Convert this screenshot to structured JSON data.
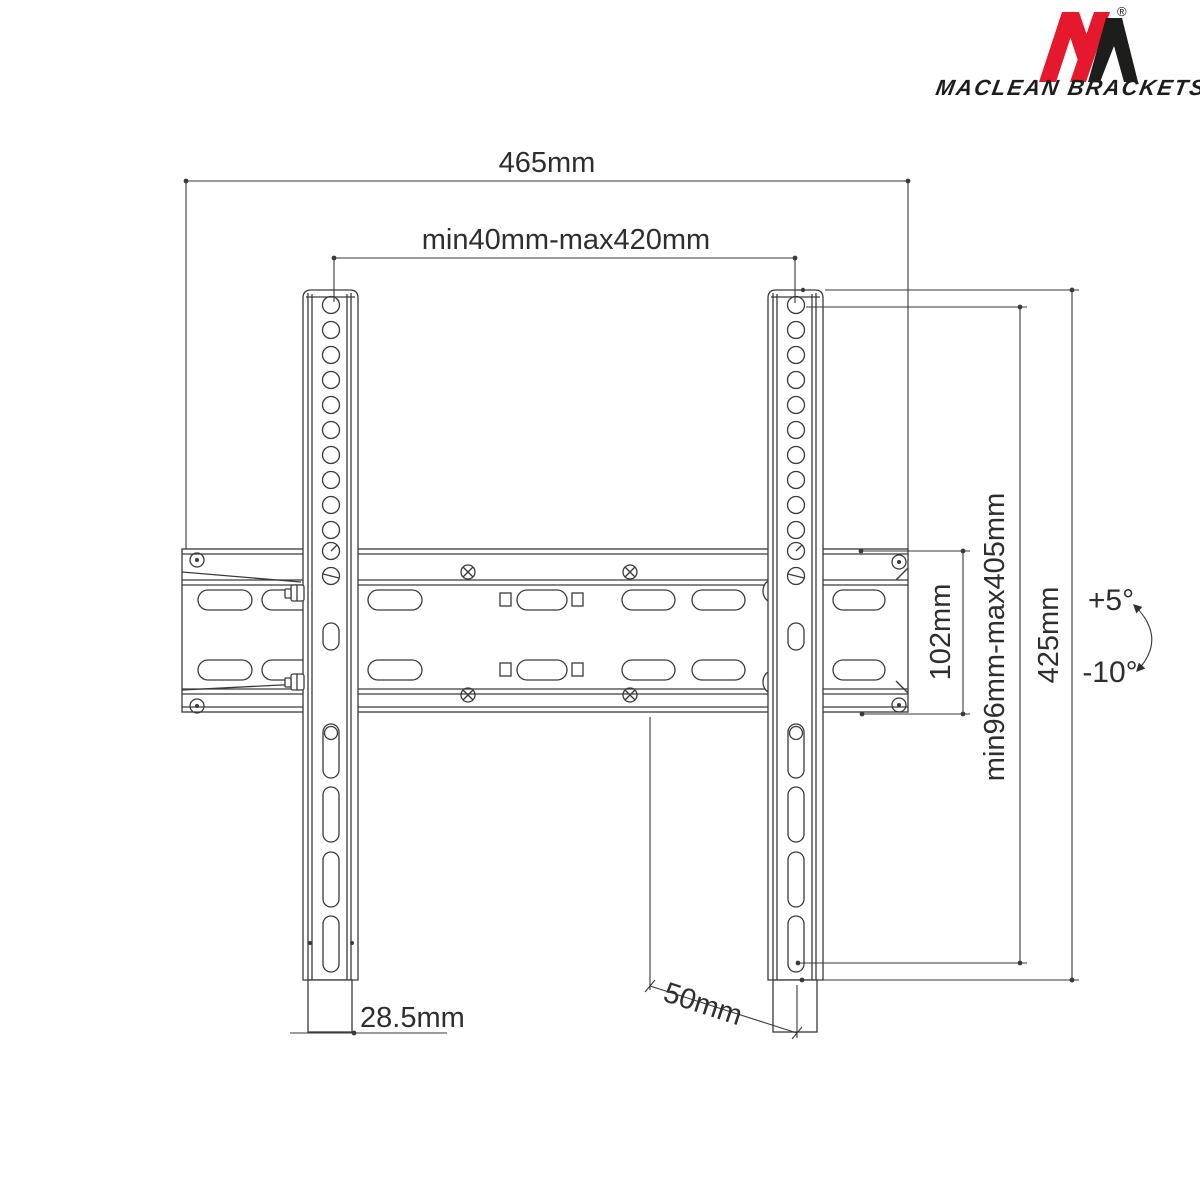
{
  "brand": {
    "name": "MACLEAN BRACKETS",
    "registered": "®",
    "logo_red": "#e6182e",
    "logo_black": "#1d1d1b"
  },
  "dimensions": {
    "total_width": "465mm",
    "vesa_width_range": "min40mm-max420mm",
    "wall_plate_height": "102mm",
    "vesa_height_range": "min96mm-max405mm",
    "bracket_height": "425mm",
    "tilt_up": "+5°",
    "tilt_down": "-10°",
    "rail_thickness": "28.5mm",
    "depth": "50mm"
  },
  "colors": {
    "line": "#3a3a3a",
    "text": "#2e2e2e",
    "background": "#ffffff"
  }
}
